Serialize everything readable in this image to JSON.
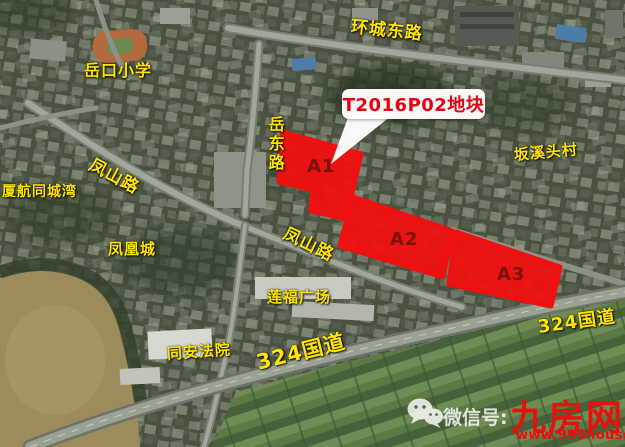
{
  "callout": {
    "label": "T2016P02地块"
  },
  "parcels": [
    {
      "label": "A1"
    },
    {
      "label": "A2"
    },
    {
      "label": "A3"
    }
  ],
  "labels": {
    "yuekou_school": "岳口小学",
    "huancheng_east_road": "环城东路",
    "yuedong_road": "岳东路",
    "fengshan_road_1": "凤山路",
    "xiahang_tongchengwan": "厦航同城湾",
    "fenghuang_city": "凤凰城",
    "fengshan_road_2": "凤山路",
    "lianfu_plaza": "莲福广场",
    "tongan_court": "同安法院",
    "g324_southwest": "324国道",
    "g324_east": "324国道",
    "banxitou_village": "坂溪头村"
  },
  "watermark": {
    "icon": "wechat-icon",
    "wechat_prefix": "微信号:",
    "site_name": "九房网",
    "site_url": "www.999house.com"
  },
  "colors": {
    "parcel_fill": "#f01010",
    "parcel_label_text": "#7e120b",
    "callout_text": "#e60012",
    "road_label_yellow": "#ffe400",
    "watermark_red": "#e8100c"
  }
}
